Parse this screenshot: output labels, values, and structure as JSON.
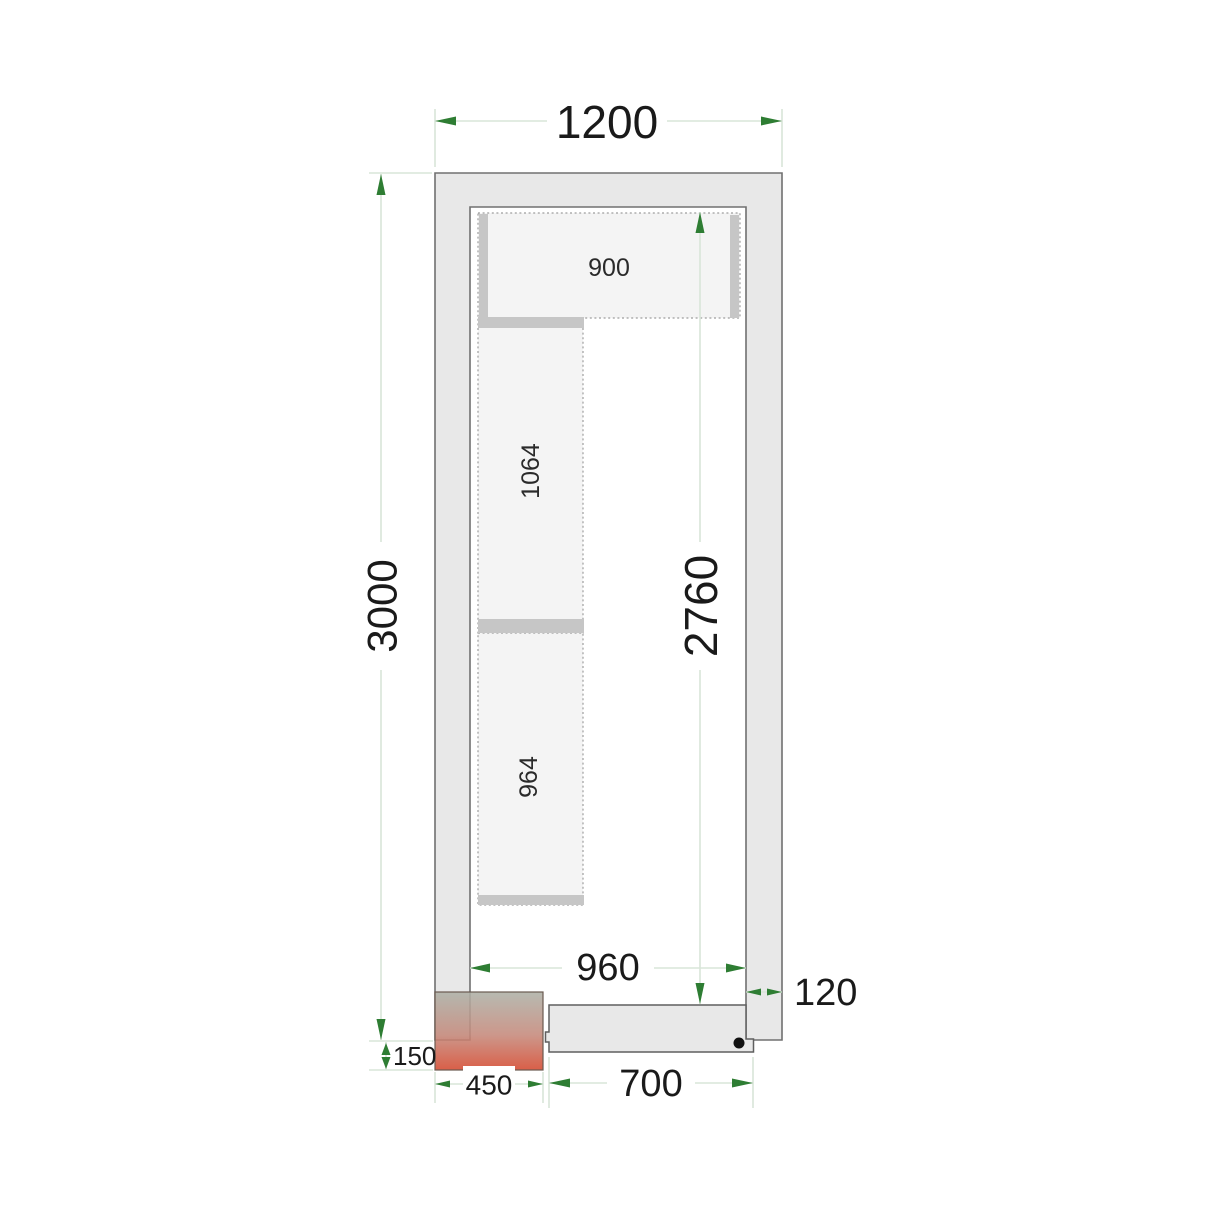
{
  "diagram": {
    "dimension_labels": {
      "outer_width": "1200",
      "outer_depth": "3000",
      "inner_depth": "2760",
      "inner_width": "960",
      "wall_thickness": "120",
      "plinth_height": "150",
      "unit_width": "450",
      "door_width": "700"
    },
    "shelf_labels": {
      "top_shelf": "900",
      "side_shelf_upper": "1064",
      "side_shelf_lower": "964"
    },
    "colors": {
      "dimension_arrow": "#2e7d33",
      "dimension_line": "#d9e5d9",
      "wall_fill": "#e8e8e8",
      "wall_stroke": "#707070",
      "shelf_fill": "#f4f4f4",
      "shelf_dash": "#9e9e9e",
      "shelf_bar": "#c6c6c6",
      "door_fill": "#e8e8e8",
      "door_handle": "#111111",
      "unit_gradient_top": "#adb0a6",
      "unit_gradient_bottom": "#d4492f",
      "text": "#1a1a1a",
      "background": "#ffffff"
    }
  }
}
